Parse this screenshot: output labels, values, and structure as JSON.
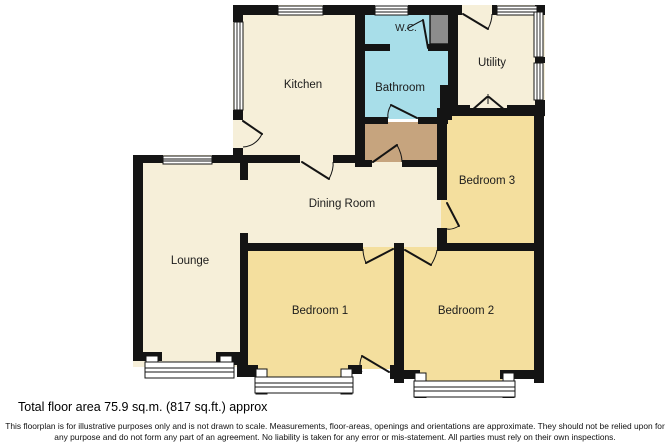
{
  "page": {
    "background": "#FFFFFF"
  },
  "colors": {
    "page": "#FFFFFF",
    "wall": "#141414",
    "room_cream": "#F6EFD9",
    "room_yellow": "#F4DF9E",
    "room_blue": "#A8DEE9",
    "hall_tan": "#C6A47E",
    "chimney_gray": "#8C8C8C",
    "window_white": "#FFFFFF",
    "label_text": "#1C1C1C"
  },
  "rooms": {
    "kitchen": {
      "label": "Kitchen"
    },
    "wc": {
      "label": "W.C."
    },
    "utility": {
      "label": "Utility"
    },
    "bathroom": {
      "label": "Bathroom"
    },
    "bedroom3": {
      "label": "Bedroom 3"
    },
    "dining_room": {
      "label": "Dining Room"
    },
    "lounge": {
      "label": "Lounge"
    },
    "bedroom1": {
      "label": "Bedroom 1"
    },
    "bedroom2": {
      "label": "Bedroom 2"
    }
  },
  "footer": {
    "total_area": "Total floor area 75.9 sq.m. (817 sq.ft.) approx",
    "disclaimer": "This floorplan is for illustrative purposes only and is not drawn to scale. Measurements, floor-areas, openings and orientations are approximate. They should not be relied upon for any purpose and do not form any part of an agreement. No liability is taken for any error or mis-statement. All parties must rely on their own inspections."
  }
}
